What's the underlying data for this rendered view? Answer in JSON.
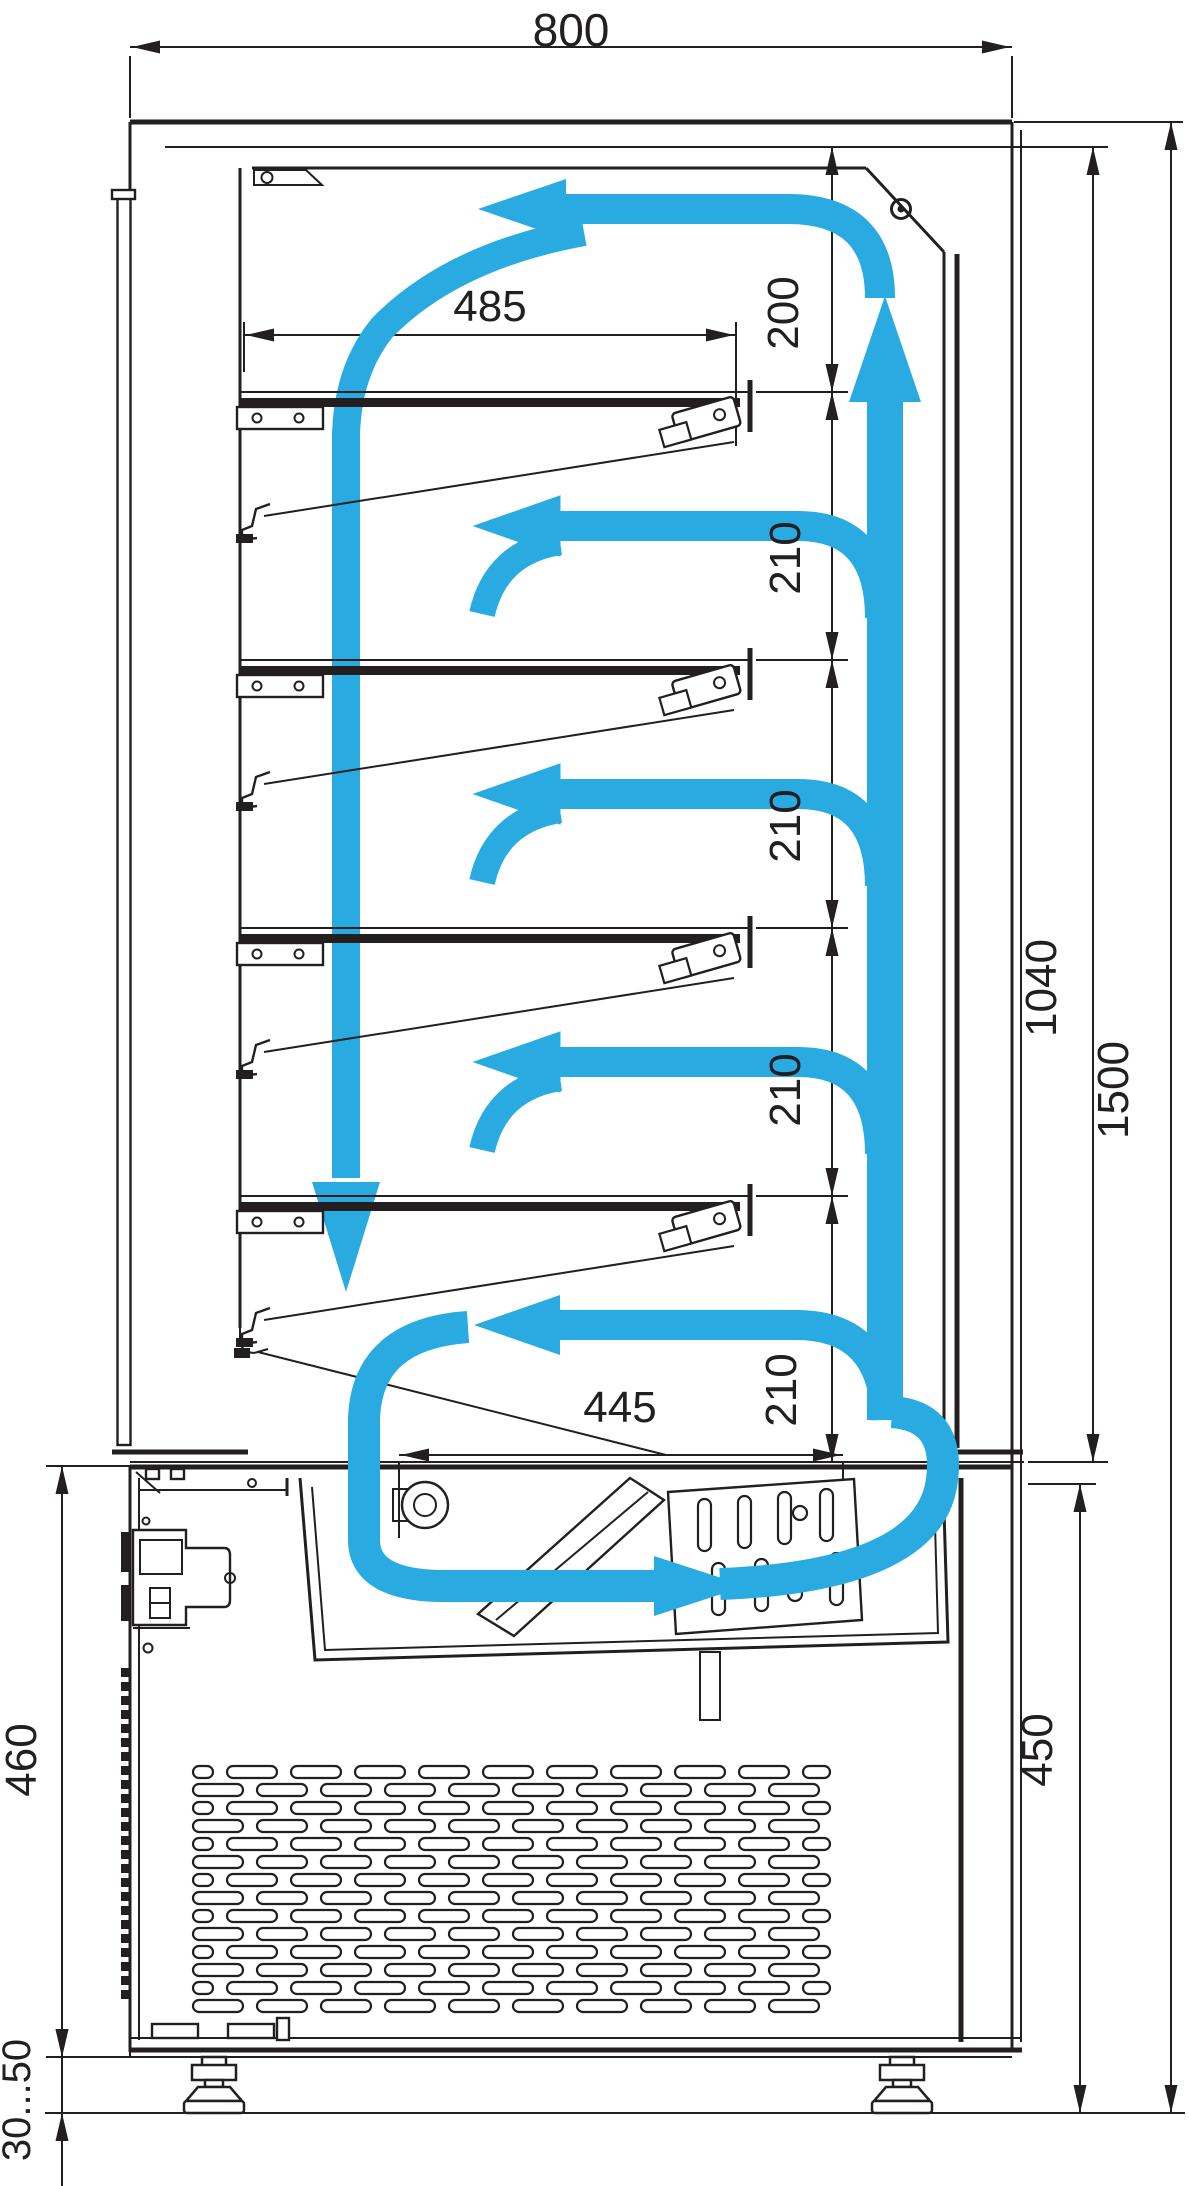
{
  "drawing": {
    "type": "refrigerated-display-case-side-section-with-air-circulation",
    "units": "mm",
    "colors": {
      "line": "#231F20",
      "airflow": "#29ABE2",
      "background": "#FFFFFF"
    },
    "dimension_labels": {
      "overall_width": "800",
      "shelf_length": "485",
      "top_gap": "200",
      "shelf_gap_1": "210",
      "shelf_gap_2": "210",
      "shelf_gap_3": "210",
      "shelf_gap_4": "210",
      "well_opening": "445",
      "display_height": "1040",
      "overall_height": "1500",
      "machine_height_left": "460",
      "machine_height_right": "450",
      "feet_range": "30...50"
    }
  }
}
